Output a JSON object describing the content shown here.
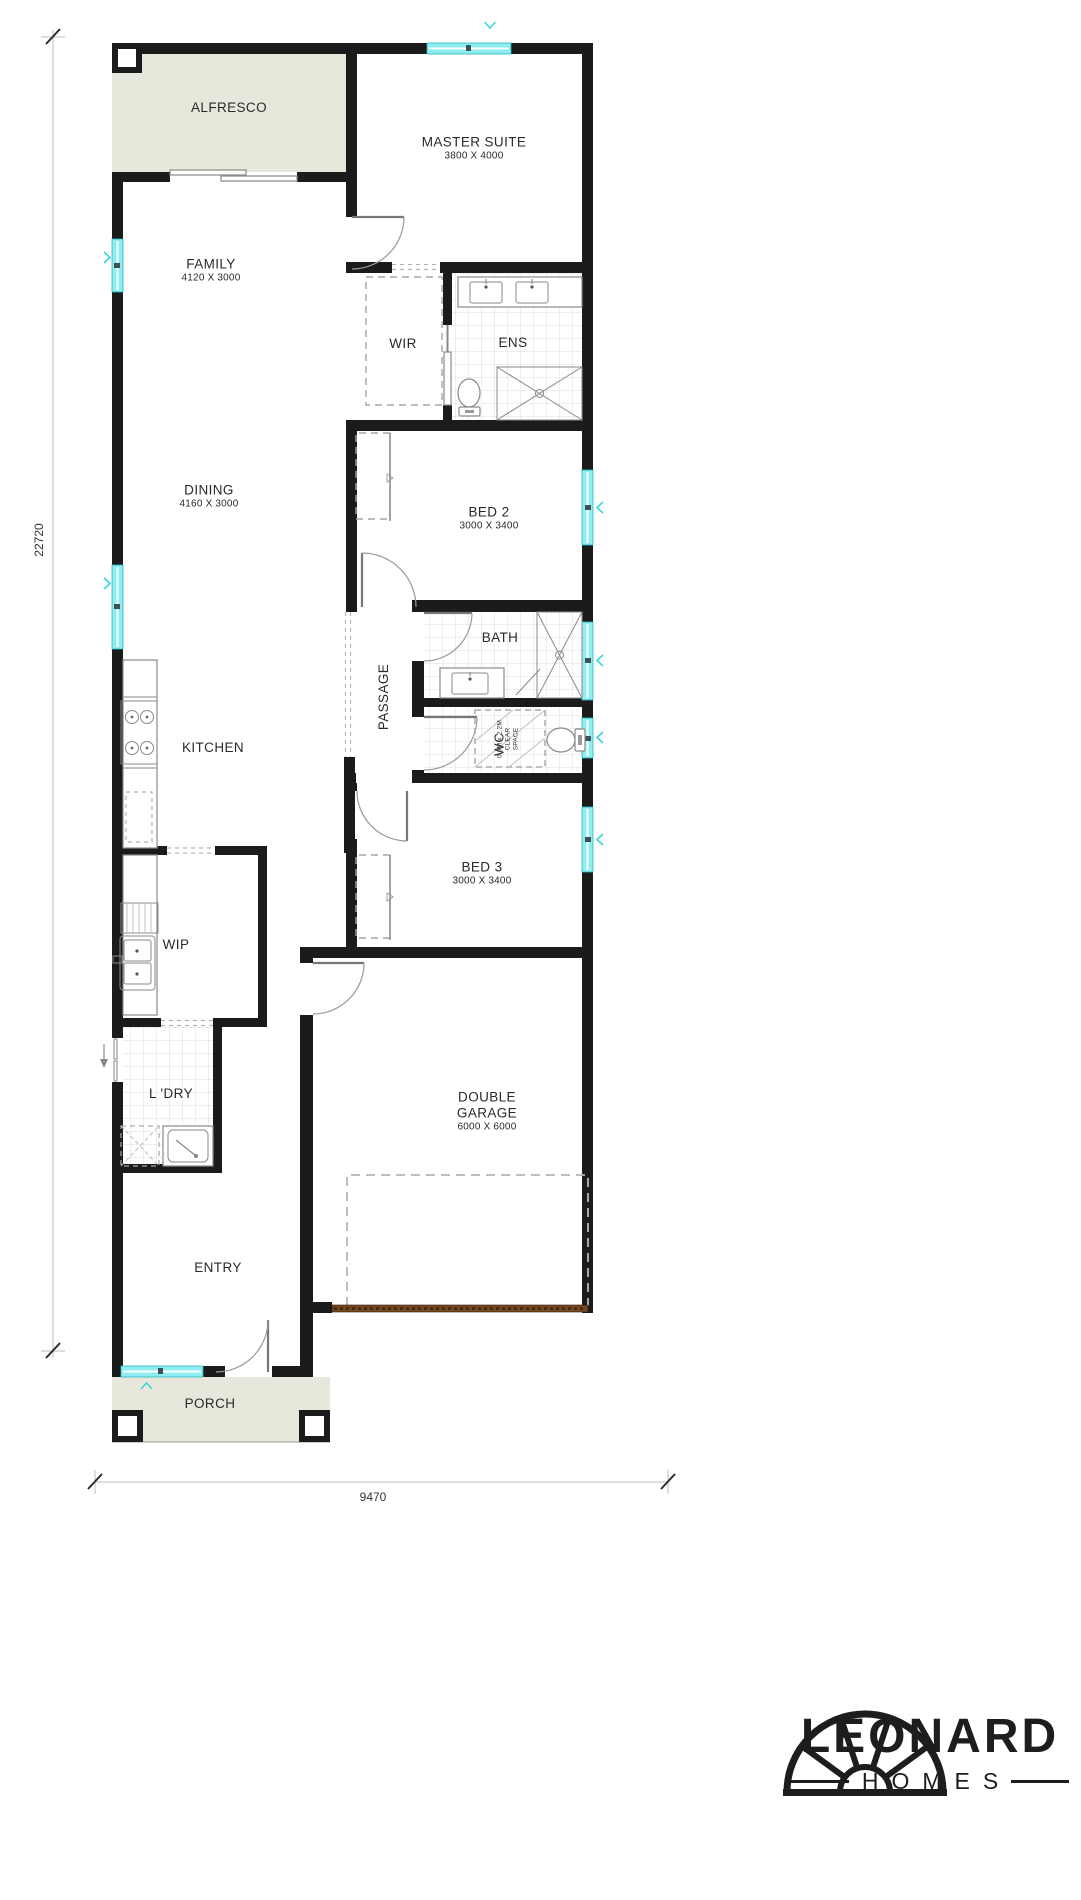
{
  "plan": {
    "rooms": {
      "alfresco": {
        "label": "ALFRESCO"
      },
      "master_suite": {
        "label": "MASTER SUITE",
        "dims": "3800 X 4000"
      },
      "family": {
        "label": "FAMILY",
        "dims": "4120 X 3000"
      },
      "wir": {
        "label": "WIR"
      },
      "ens": {
        "label": "ENS"
      },
      "dining": {
        "label": "DINING",
        "dims": "4160 X 3000"
      },
      "bed2": {
        "label": "BED 2",
        "dims": "3000 X 3400"
      },
      "bath": {
        "label": "BATH"
      },
      "passage": {
        "label": "PASSAGE"
      },
      "kitchen": {
        "label": "KITCHEN"
      },
      "wc": {
        "label": "WC",
        "clear_space_line1": "0.9M x 2.2M",
        "clear_space_line2": "CLEAR",
        "clear_space_line3": "SPACE"
      },
      "bed3": {
        "label": "BED 3",
        "dims": "3000 X 3400"
      },
      "wip": {
        "label": "WIP"
      },
      "laundry": {
        "label": "L 'DRY"
      },
      "garage": {
        "line1": "DOUBLE",
        "line2": "GARAGE",
        "dims": "6000 X 6000"
      },
      "entry": {
        "label": "ENTRY"
      },
      "porch": {
        "label": "PORCH"
      }
    },
    "dimensions": {
      "overall_depth": "22720",
      "overall_width": "9470"
    }
  },
  "logo": {
    "brand": "LEONARD",
    "sub": "HOMES"
  },
  "colors": {
    "wall": "#1b1b1b",
    "window_fill": "#8deef2",
    "window_accent": "#2ab8c4",
    "outdoor_fill": "#e8e7dc",
    "garage_door": "#74481f",
    "tile_line": "#dcdcdc",
    "label_text": "#2a2a2a"
  }
}
